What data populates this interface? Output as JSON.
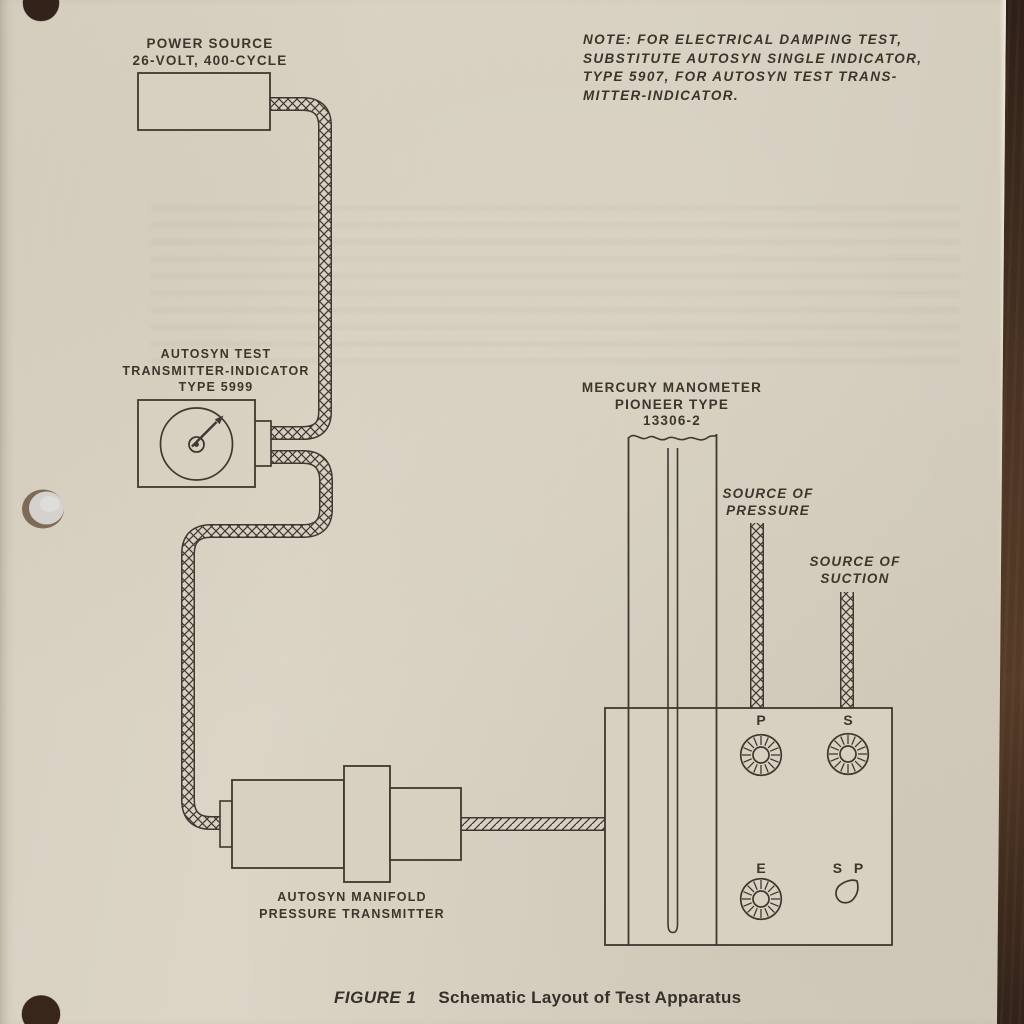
{
  "document": {
    "note_lines": [
      "NOTE: FOR ELECTRICAL DAMPING TEST,",
      "SUBSTITUTE AUTOSYN SINGLE INDICATOR,",
      "TYPE 5907, FOR AUTOSYN TEST TRANS-",
      "MITTER-INDICATOR."
    ],
    "power_source": {
      "label_lines": [
        "POWER SOURCE",
        "26-VOLT, 400-CYCLE"
      ]
    },
    "autosyn_indicator": {
      "label_lines": [
        "AUTOSYN TEST",
        "TRANSMITTER-INDICATOR",
        "TYPE 5999"
      ]
    },
    "mercury_manometer": {
      "label_lines": [
        "MERCURY MANOMETER",
        "PIONEER TYPE",
        "13306-2"
      ]
    },
    "pressure_source": {
      "label_lines": [
        "SOURCE OF",
        "PRESSURE"
      ]
    },
    "suction_source": {
      "label_lines": [
        "SOURCE OF",
        "SUCTION"
      ]
    },
    "manifold_transmitter": {
      "label_lines": [
        "AUTOSYN MANIFOLD",
        "PRESSURE TRANSMITTER"
      ]
    },
    "control_panel": {
      "knob_p": "P",
      "knob_s": "S",
      "knob_e": "E",
      "selector": "S P"
    },
    "caption": {
      "figure": "FIGURE 1",
      "title": "Schematic Layout of Test Apparatus"
    },
    "colors": {
      "paper": "#d8d1c2",
      "ink": "#3e3830",
      "table_background": "#4e3625"
    }
  }
}
